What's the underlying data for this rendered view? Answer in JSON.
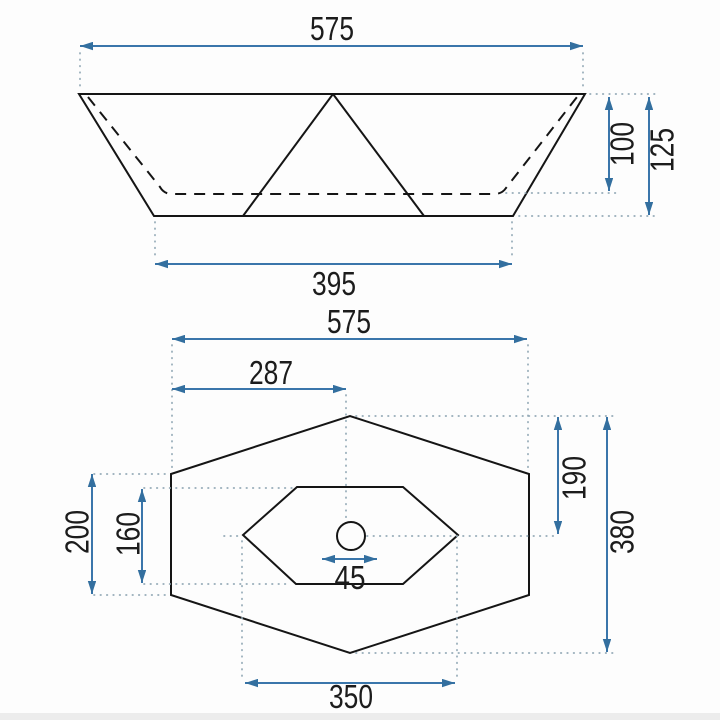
{
  "drawing": {
    "type": "washbasin technical drawing, two orthographic views",
    "colors": {
      "dimension_blue": "#3a76ab",
      "extension_dotted_gray": "#93a9b6",
      "outline_black": "#151515"
    }
  },
  "front_view": {
    "top_width": "575",
    "basin_depth": "100",
    "total_height": "125",
    "bottom_width": "395"
  },
  "plan_view": {
    "total_width": "575",
    "drain_center_from_left": "287",
    "drain_center_from_top": "190",
    "total_depth": "380",
    "side_edge_height": "200",
    "basin_inner_depth": "160",
    "drain_diameter": "45",
    "basin_inner_width": "350"
  }
}
